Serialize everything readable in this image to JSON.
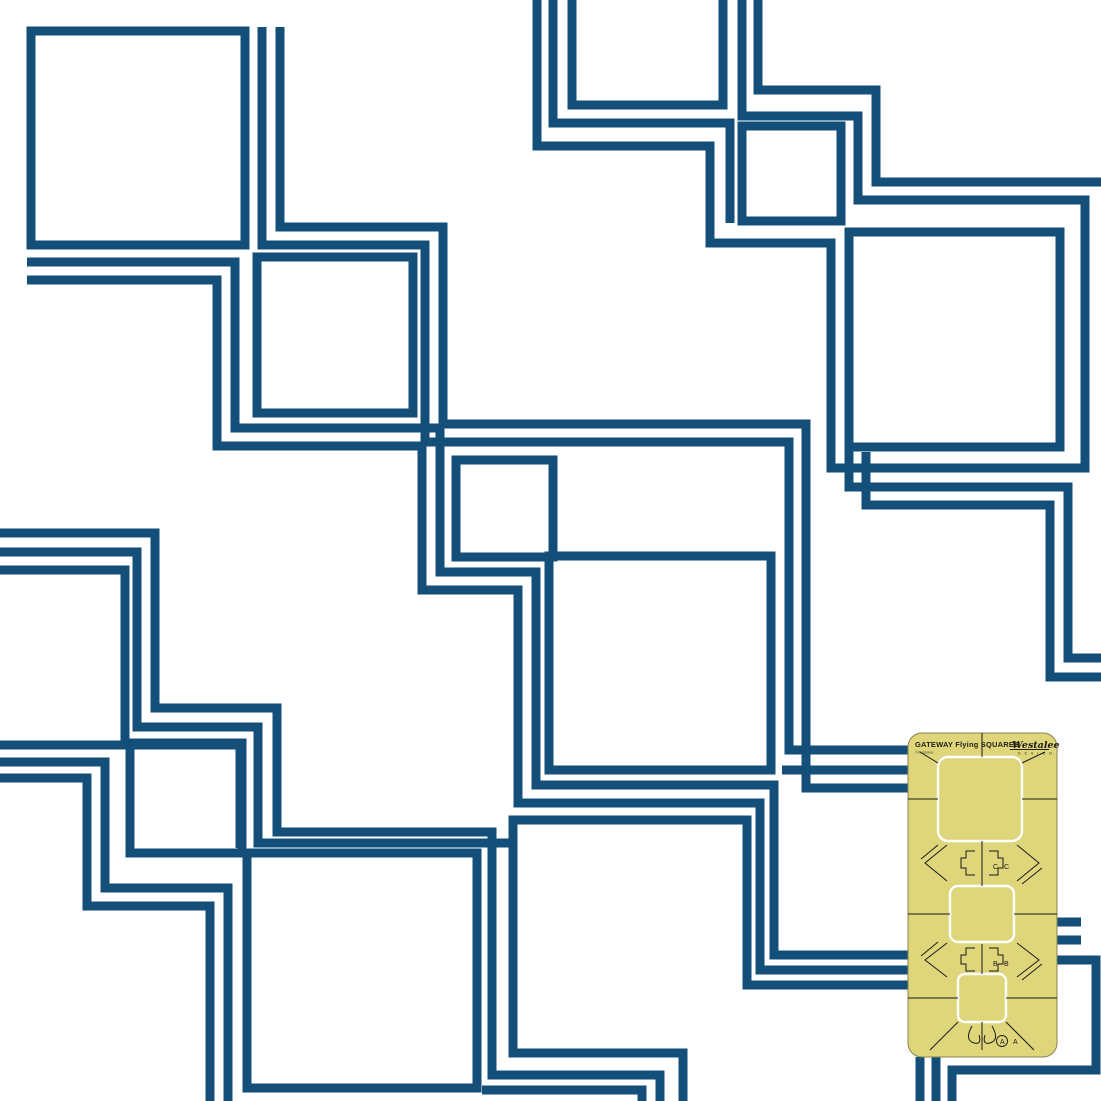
{
  "canvas": {
    "width": 1101,
    "height": 1101,
    "background": "#ffffff"
  },
  "pattern": {
    "name": "flying-squares-continuous-line-quilting-pattern",
    "line_color": "#134F78",
    "line_width": 9,
    "paths": [
      {
        "id": "square-a1",
        "d": "M31,31 H245 V245 H31 Z"
      },
      {
        "id": "square-a2",
        "d": "M257,257 H413 V413 H257 Z"
      },
      {
        "id": "square-a3",
        "d": "M456,460 H553 V557 H456 Z"
      },
      {
        "id": "square-a4",
        "d": "M549,556 H771 V770 H549 Z"
      },
      {
        "id": "square-a4-tail",
        "d": "M782,770 H950"
      },
      {
        "id": "echo-a-inner",
        "d": "M262,27 V245 H425 V442 H789 V750 H950"
      },
      {
        "id": "echo-a-outer",
        "d": "M280,27 V227 H443 V424 H806 V788 H950"
      },
      {
        "id": "echo-a-low-1",
        "d": "M27,262 H235 V428 H440 V572 H536 V785 H774 V955 H950"
      },
      {
        "id": "echo-a-low-2",
        "d": "M27,280 H217 V446 H422 V590 H518 V803 H760 V970 H950"
      },
      {
        "id": "square-b1",
        "d": "M572,-12 H723 V105 H572 Z"
      },
      {
        "id": "meander-b",
        "d": "M742,-5 V116 H858 V200 H1085 V468 H831 V243 H710 V146 H537 V-5"
      },
      {
        "id": "echo-b-outer",
        "d": "M758,-5 V90 H876 V182 H1106"
      },
      {
        "id": "entry-b-left",
        "d": "M553,-5 V123 H730 V223"
      },
      {
        "id": "square-b2",
        "d": "M742,126 H841 V221 H742 Z"
      },
      {
        "id": "square-b3",
        "d": "M849,232 H1060 V447 H849 Z"
      },
      {
        "id": "b3-wrap-1",
        "d": "M849,447 V487 H1068 V658 H1106"
      },
      {
        "id": "b3-wrap-2",
        "d": "M866,452 V505 H1050 V677 H1106"
      },
      {
        "id": "entry-c-1",
        "d": "M-5,533 H155 V708 H277 V832 H492 V1075 H660 V1101"
      },
      {
        "id": "entry-c-2",
        "d": "M-5,552 H137 V727 H258 V843 H509"
      },
      {
        "id": "square-c1",
        "d": "M-12,570 H125 V745 H-12 Z"
      },
      {
        "id": "link-c1-c2",
        "d": "M125,745 H240 V848"
      },
      {
        "id": "echo-c-1",
        "d": "M-5,762 H105 V888 H228 V1101"
      },
      {
        "id": "echo-c-2",
        "d": "M-5,778 H87 V906 H210 V1101"
      },
      {
        "id": "square-c2",
        "d": "M130,743 H242 V853 H130 Z"
      },
      {
        "id": "square-c3",
        "d": "M247,853 H477 V1088 H247 Z"
      },
      {
        "id": "c3-tail",
        "d": "M482,1090 H642 V1101"
      },
      {
        "id": "square-d1-open",
        "d": "M683,1101 V1053 H513 V820 H747 V985 H950"
      },
      {
        "id": "stub-right-1",
        "d": "M950,922 H1081"
      },
      {
        "id": "stub-right-2",
        "d": "M950,940 H1081"
      },
      {
        "id": "wrap-corner",
        "d": "M950,960 H1096 V1070 H952 V1101"
      },
      {
        "id": "stub-bottom-1",
        "d": "M920,1057 V1101"
      },
      {
        "id": "stub-bottom-2",
        "d": "M936,1057 V1101"
      }
    ]
  },
  "template_tool": {
    "name": "GATEWAY Flying SQUARES quilting template",
    "x": 908,
    "y": 733,
    "width": 149,
    "height": 324,
    "corner_radius": 14,
    "fill": "#DFD57A",
    "edge_color": "#8a8450",
    "cutout_color": "#ffffff",
    "mark_color": "#1b1b1b",
    "header": {
      "title": "GATEWAY Flying SQUARES",
      "fineprint": "©Westalee"
    },
    "logo": {
      "name": "Westalee",
      "sub": "D E S I G N"
    },
    "cutouts": [
      {
        "x": 938,
        "y": 757,
        "w": 84,
        "h": 84,
        "r": 10
      },
      {
        "x": 950,
        "y": 886,
        "w": 64,
        "h": 56,
        "r": 8
      },
      {
        "x": 958,
        "y": 974,
        "w": 48,
        "h": 48,
        "r": 7
      }
    ],
    "marks": [
      "M982,733 V757",
      "M982,841 V886",
      "M982,944 V974",
      "M982,1022 V1050",
      "M908,799 H938",
      "M1022,799 H1057",
      "M908,914 H950",
      "M1014,914 H1057",
      "M908,998 H958",
      "M1006,998 H1057",
      "M920,752 L938,763",
      "M1045,752 L1022,763",
      "M947,845 L925,863 L947,881",
      "M1017,845 L1039,863 L1017,881",
      "M938,845 L921,859",
      "M1022,884 L1042,868",
      "M975,851 H966 V858 H961 V868 H966 V875 H975",
      "M989,851 H998 V858 H1003 V868 H998 V875 H989",
      "M947,943 L925,960 L947,977",
      "M1017,943 L1039,960 L1017,977",
      "M938,942 L921,956",
      "M1022,980 L1042,964",
      "M975,948 H966 V955 H961 V964 H966 V971 H975",
      "M989,948 H998 V955 H1003 V964 H998 V971 H989",
      "M958,1022 L930,1050",
      "M1006,1022 L1034,1050",
      "M972,1026 Q964,1040 974,1043 Q982,1045 979,1035",
      "M992,1026 Q1000,1040 990,1043 Q982,1045 985,1035",
      "M982,1050 L982,1022"
    ],
    "letters": [
      {
        "t": "C",
        "x": 993,
        "y": 869
      },
      {
        "t": "C",
        "x": 1004,
        "y": 869
      },
      {
        "t": "B",
        "x": 993,
        "y": 966
      },
      {
        "t": "B",
        "x": 1004,
        "y": 966
      },
      {
        "t": "A",
        "x": 1000,
        "y": 1044
      },
      {
        "t": "A",
        "x": 1013,
        "y": 1044
      }
    ],
    "letter_circle": {
      "cx": 1002,
      "cy": 1041,
      "r": 5.5
    }
  }
}
